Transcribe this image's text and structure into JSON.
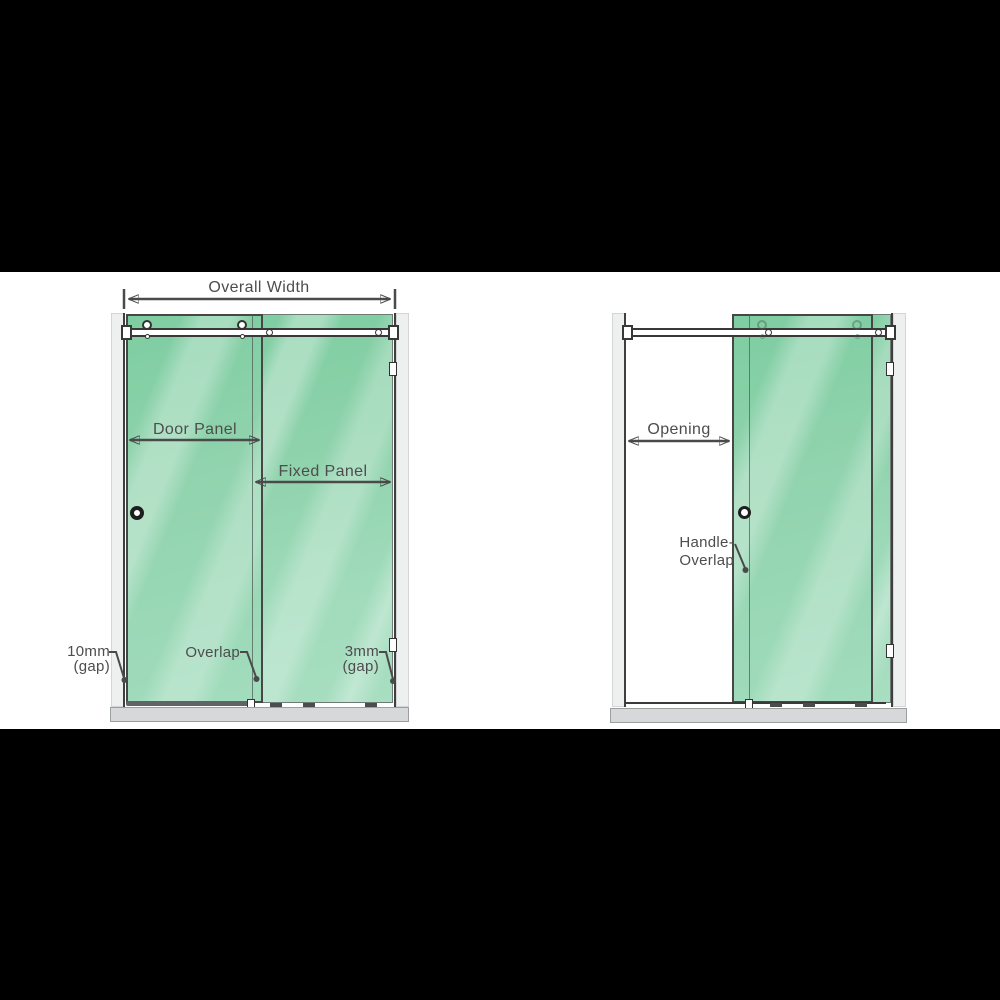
{
  "figure": {
    "letterbox_color": "#000000",
    "background_color": "#ffffff",
    "line_color": "#4a4a4a",
    "glass_color": "#8ed2ab",
    "tray_color": "#d6d8da"
  },
  "left_view": {
    "labels": {
      "overall_width": "Overall Width",
      "door_panel": "Door Panel",
      "fixed_panel": "Fixed Panel",
      "gap_left_line1": "10mm",
      "gap_left_line2": "(gap)",
      "overlap": "Overlap",
      "gap_right_line1": "3mm",
      "gap_right_line2": "(gap)"
    }
  },
  "right_view": {
    "labels": {
      "opening": "Opening",
      "handle_overlap_line1": "Handle-",
      "handle_overlap_line2": "Overlap"
    }
  }
}
